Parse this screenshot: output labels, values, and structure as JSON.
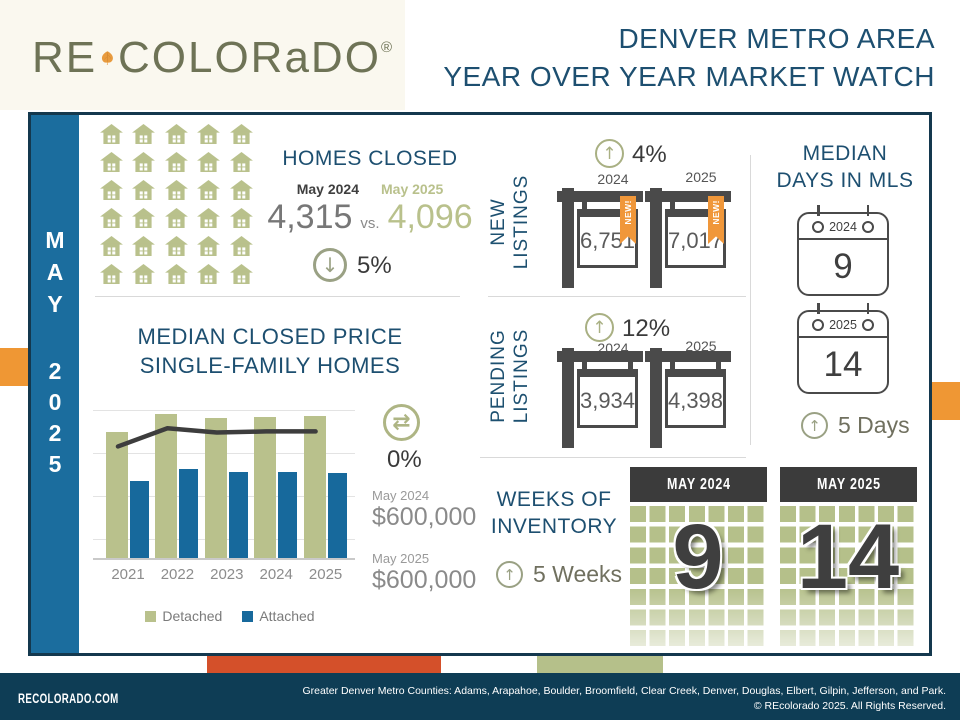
{
  "logo": {
    "re": "RE",
    "colorado": "COLORaDO",
    "reg": "®",
    "leaf_color": "#e89b3e",
    "text_color": "#6e7356"
  },
  "header": {
    "title_line1": "DENVER METRO AREA",
    "title_line2": "YEAR OVER YEAR MARKET WATCH"
  },
  "sidebar": {
    "month": "MAY",
    "year": "2025"
  },
  "homes_closed": {
    "title": "HOMES CLOSED",
    "icon_grid": {
      "rows": 6,
      "cols": 5,
      "icon": "house-icon",
      "color": "#b9c18c"
    },
    "prev_label": "May 2024",
    "prev_value": "4,315",
    "vs": "vs.",
    "curr_label": "May 2025",
    "curr_value": "4,096",
    "change": {
      "direction": "down",
      "icon": "arrow-down-circle-icon",
      "value": "5%"
    }
  },
  "median_price": {
    "title_line1": "MEDIAN CLOSED PRICE",
    "title_line2": "SINGLE-FAMILY HOMES",
    "change": {
      "direction": "flat",
      "icon": "arrows-swap-circle-icon",
      "value": "0%"
    },
    "prev_label": "May 2024",
    "prev_value": "$600,000",
    "curr_label": "May 2025",
    "curr_value": "$600,000"
  },
  "chart_data": {
    "type": "bar",
    "categories": [
      "2021",
      "2022",
      "2023",
      "2024",
      "2025"
    ],
    "series": [
      {
        "name": "Detached",
        "type": "bar",
        "color": "#b9c18c",
        "values": [
          590000,
          670000,
          655000,
          660000,
          665000
        ]
      },
      {
        "name": "Attached",
        "type": "bar",
        "color": "#17699c",
        "values": [
          360000,
          415000,
          400000,
          400000,
          395000
        ]
      },
      {
        "name": "Median Closed Price",
        "type": "line",
        "color": "#3d3d3d",
        "values": [
          530000,
          615000,
          595000,
          600000,
          600000
        ]
      }
    ],
    "title": "MEDIAN CLOSED PRICE SINGLE-FAMILY HOMES",
    "xlabel": "",
    "ylabel": "",
    "ylim": [
      0,
      700000
    ],
    "grid": true,
    "legend": [
      "Detached",
      "Attached"
    ],
    "legend_position": "bottom"
  },
  "new_listings": {
    "label_line1": "NEW",
    "label_line2": "LISTINGS",
    "change": {
      "direction": "up",
      "icon": "arrow-up-circle-icon",
      "value": "4%"
    },
    "ribbon": "NEW!",
    "y2024": {
      "label": "2024",
      "value": "6,751"
    },
    "y2025": {
      "label": "2025",
      "value": "7,017"
    }
  },
  "pending_listings": {
    "label_line1": "PENDING",
    "label_line2": "LISTINGS",
    "change": {
      "direction": "up",
      "icon": "arrow-up-circle-icon",
      "value": "12%"
    },
    "y2024": {
      "label": "2024",
      "value": "3,934"
    },
    "y2025": {
      "label": "2025",
      "value": "4,398"
    }
  },
  "median_days": {
    "title_line1": "MEDIAN",
    "title_line2": "DAYS IN MLS",
    "y2024": {
      "label": "2024",
      "value": "9"
    },
    "y2025": {
      "label": "2025",
      "value": "14"
    },
    "change": {
      "direction": "up",
      "icon": "arrow-up-circle-icon",
      "value": "5 Days"
    }
  },
  "weeks_inventory": {
    "title_line1": "WEEKS OF",
    "title_line2": "INVENTORY",
    "change": {
      "direction": "up",
      "icon": "arrow-up-circle-icon",
      "value": "5 Weeks"
    },
    "y2024": {
      "header": "MAY 2024",
      "value": "9"
    },
    "y2025": {
      "header": "MAY 2025",
      "value": "14"
    }
  },
  "footer": {
    "site": "RECOLORADO.COM",
    "line1": "Greater Denver Metro Counties: Adams, Arapahoe, Boulder, Broomfield, Clear Creek, Denver, Douglas, Elbert, Gilpin, Jefferson, and Park.",
    "line2": "© REcolorado 2025. All Rights Reserved."
  },
  "colors": {
    "heading_teal": "#1d4f70",
    "sidebar_blue": "#1b6d9e",
    "panel_border": "#14384e",
    "footer_navy": "#0e3d55",
    "olive": "#b9c18c",
    "accent_orange": "#ef9734",
    "block_red_orange": "#d4502a",
    "sign_gray": "#4a4a4a"
  },
  "glyphs": {
    "up": "↑",
    "down": "↓",
    "swap": "⇄"
  }
}
